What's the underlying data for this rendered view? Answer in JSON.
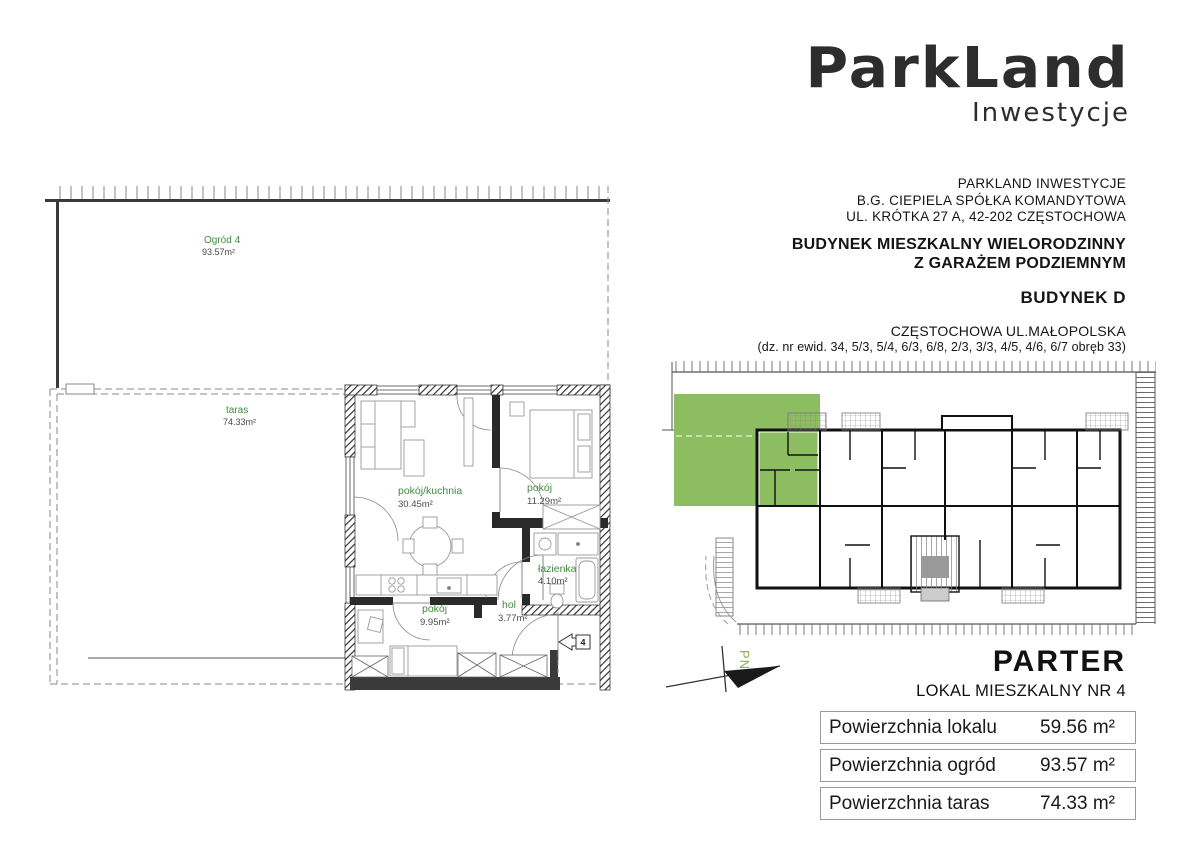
{
  "logo": {
    "brand": "ParkLand",
    "sub": "Inwestycje"
  },
  "header": {
    "company_lines": [
      "PARKLAND INWESTYCJE",
      "B.G. CIEPIELA SPÓŁKA KOMANDYTOWA",
      "UL. KRÓTKA 27 A, 42-202 CZĘSTOCHOWA"
    ],
    "building_title_line1": "BUDYNEK MIESZKALNY WIELORODZINNY",
    "building_title_line2": "Z GARAŻEM PODZIEMNYM",
    "building_name": "BUDYNEK D",
    "location": "CZĘSTOCHOWA UL.MAŁOPOLSKA",
    "plots": "(dz. nr ewid. 34, 5/3, 5/4, 6/3, 6/8, 2/3, 3/3, 4/5, 4/6, 6/7 obręb 33)"
  },
  "floor_plan": {
    "garden": {
      "name": "Ogród 4",
      "area": "93.57m²"
    },
    "terrace": {
      "name": "taras",
      "area": "74.33m²"
    },
    "rooms": [
      {
        "name": "pokój/kuchnia",
        "area": "30.45m²"
      },
      {
        "name": "pokój",
        "area": "11.29m²"
      },
      {
        "name": "łazienka",
        "area": "4.10m²"
      },
      {
        "name": "pokój",
        "area": "9.95m²"
      },
      {
        "name": "hol",
        "area": "3.77m²"
      }
    ],
    "entrance_number": "4"
  },
  "site_plan": {
    "north_label": "PN",
    "highlight_color": "#8cbd60"
  },
  "summary": {
    "floor_title": "PARTER",
    "unit_title": "LOKAL MIESZKALNY NR 4",
    "rows": [
      {
        "label": "Powierzchnia lokalu",
        "value": "59.56 m²"
      },
      {
        "label": "Powierzchnia ogród",
        "value": "93.57 m²"
      },
      {
        "label": "Powierzchnia taras",
        "value": "74.33 m²"
      }
    ]
  }
}
